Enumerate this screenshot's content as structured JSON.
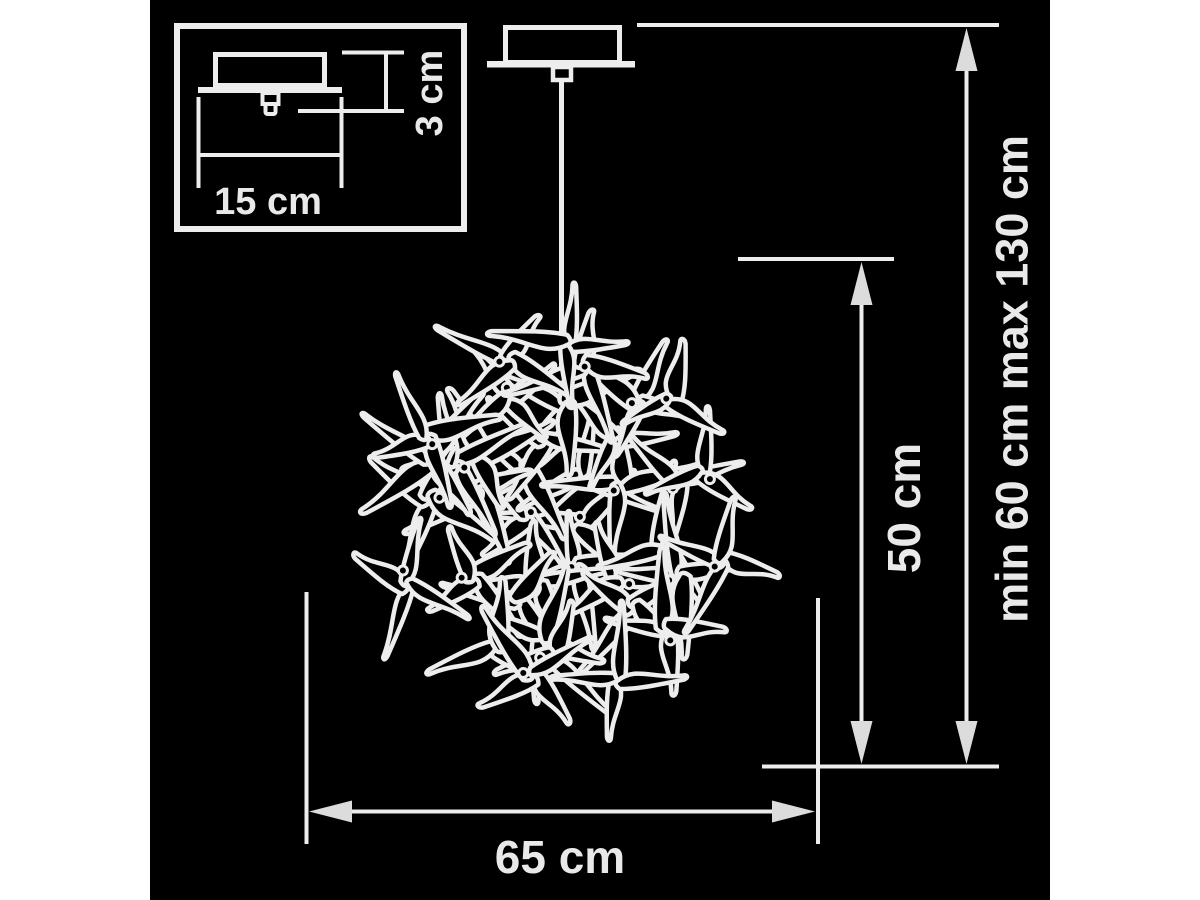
{
  "labels": {
    "inset_width": "15 cm",
    "inset_height": "3 cm",
    "ball_width": "65 cm",
    "ball_height": "50 cm",
    "hanging_height": "min 60 cm max 130 cm"
  },
  "colors": {
    "page_background": "#ffffff",
    "board_background": "#000000",
    "line": "#ededed",
    "text": "#e9e9e9",
    "arrow": "#dcdcdc"
  }
}
